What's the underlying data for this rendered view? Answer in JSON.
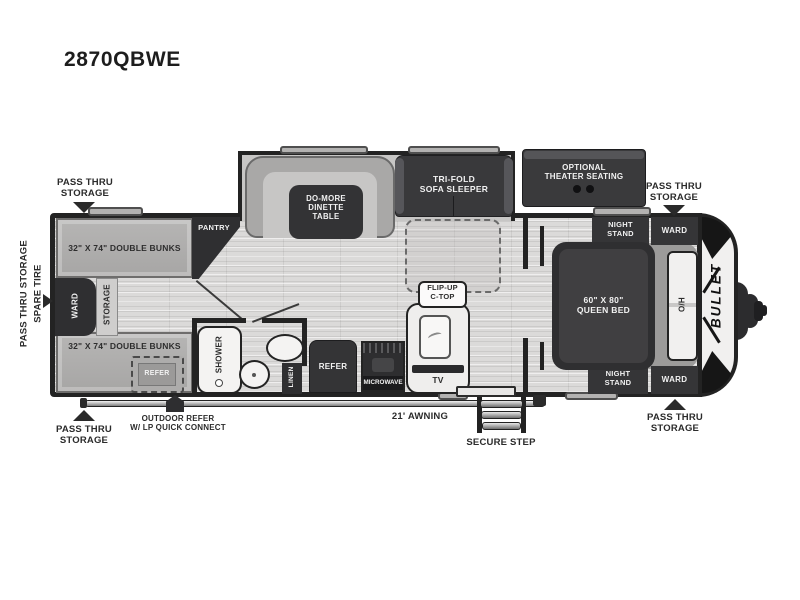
{
  "page": {
    "model": "2870QBWE",
    "brand_logo": "BULLET"
  },
  "colors": {
    "wall": "#232323",
    "dark_furniture": "#343436",
    "floor": "#dbdad9",
    "label_text": "#2b2b2b"
  },
  "callouts": {
    "pass_thru_top_left": "PASS THRU\nSTORAGE",
    "pass_thru_top_right": "PASS THRU\nSTORAGE",
    "pass_thru_bottom_left": "PASS THRU\nSTORAGE",
    "pass_thru_bottom_right": "PASS THRU\nSTORAGE",
    "side_storage": "PASS THRU STORAGE",
    "side_spare_tire": "SPARE TIRE",
    "outdoor_refer": "OUTDOOR REFER\nW/ LP QUICK CONNECT",
    "awning": "21' AWNING",
    "secure_step": "SECURE STEP"
  },
  "interior": {
    "bunk_top": "32\" X 74\" DOUBLE BUNKS",
    "bunk_bottom": "32\" X 74\" DOUBLE BUNKS",
    "ward_bunkroom": "WARD",
    "storage_bunkroom": "STORAGE",
    "pantry": "PANTRY",
    "refer_bunkroom": "REFER",
    "dinette": "DO-MORE\nDINETTE\nTABLE",
    "sofa": "TRI-FOLD\nSOFA SLEEPER",
    "theater_seating": "OPTIONAL\nTHEATER SEATING",
    "flip_up_ctop": "FLIP-UP\nC-TOP",
    "shower": "SHOWER",
    "linen": "LINEN",
    "refer_kitchen": "REFER",
    "microwave": "MICROWAVE",
    "tv": "TV",
    "night_stand_top": "NIGHT\nSTAND",
    "night_stand_bottom": "NIGHT\nSTAND",
    "ward_bed_top": "WARD",
    "ward_bed_bottom": "WARD",
    "queen_bed": "60\" X 80\"\nQUEEN BED",
    "overhead_cabinet": "O/H"
  }
}
